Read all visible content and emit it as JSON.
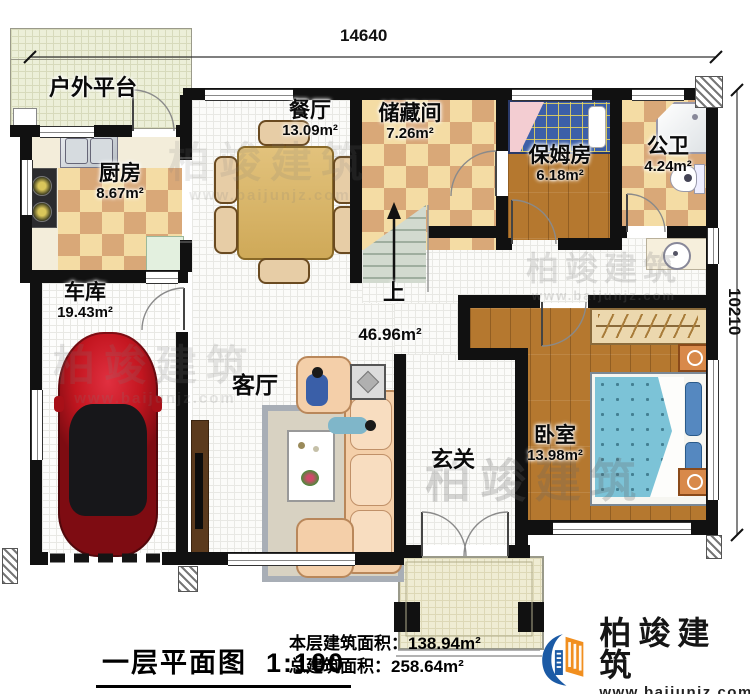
{
  "plan": {
    "type": "residential-floor-plan",
    "stairs_label": "上"
  },
  "dimensions": {
    "top": "14640",
    "right": "10210"
  },
  "rooms": [
    {
      "id": "platform",
      "name": "户外平台",
      "area": ""
    },
    {
      "id": "kitchen",
      "name": "厨房",
      "area": "8.67m²"
    },
    {
      "id": "dining",
      "name": "餐厅",
      "area": "13.09m²"
    },
    {
      "id": "storage",
      "name": "储藏间",
      "area": "7.26m²"
    },
    {
      "id": "nanny",
      "name": "保姆房",
      "area": "6.18m²"
    },
    {
      "id": "bath",
      "name": "公卫",
      "area": "4.24m²"
    },
    {
      "id": "garage",
      "name": "车库",
      "area": "19.43m²"
    },
    {
      "id": "living",
      "name": "客厅",
      "area": "46.96m²"
    },
    {
      "id": "foyer",
      "name": "玄关",
      "area": ""
    },
    {
      "id": "bedroom",
      "name": "卧室",
      "area": "13.98m²"
    }
  ],
  "title_block": {
    "title": "一层平面图",
    "scale": "1:100",
    "floor_area_label": "本层建筑面积：",
    "floor_area": "138.94m²",
    "total_area_label": "总建筑面积：",
    "total_area": "258.64m²"
  },
  "brand": {
    "name": "柏竣建筑",
    "website": "www.baijunjz.com"
  },
  "watermark": {
    "text": "柏竣建筑",
    "url": "www.baijunjz.com"
  },
  "colors": {
    "wall": "#111111",
    "brand_blue": "#1b5aa5",
    "brand_orange": "#f18f1f",
    "checker_light": "#f4dca4",
    "checker_dark": "#d9a878",
    "wood": "#b5782f",
    "mattress_blue": "#7cc3d7",
    "car_red": "#c41620"
  }
}
